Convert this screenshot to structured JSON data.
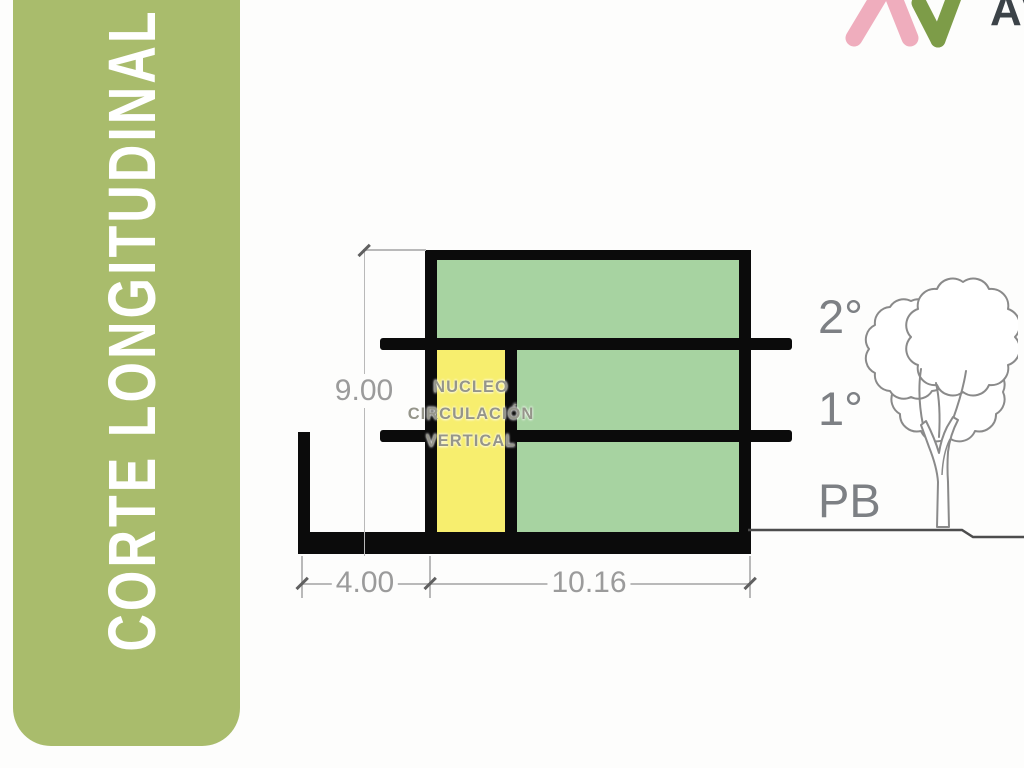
{
  "sidebar": {
    "title": "CORTE LONGITUDINAL"
  },
  "logo": {
    "text": "AV"
  },
  "drawing": {
    "floors": [
      {
        "label": "2°"
      },
      {
        "label": "1°"
      },
      {
        "label": "PB"
      }
    ],
    "core_label_lines": [
      "NUCLEO",
      "CIRCULACIÓN",
      "VERTICAL"
    ],
    "dimensions": {
      "height": "9.00",
      "left_width": "4.00",
      "right_width": "10.16"
    }
  },
  "theme": {
    "page_bg": "#fdfdfc",
    "sidebar_green": "#a9bc6c",
    "title_white": "#ffffff",
    "floor_green": "#a7d3a1",
    "core_yellow": "#f7ee6e",
    "outline_black": "#0b0b0b",
    "dim_line": "#b9b9b9",
    "dim_text": "#9b9b9b",
    "label_gray": "#7d8084",
    "ground_gray": "#4d4d4d",
    "tree_gray": "#8a8a8a",
    "logo_pink": "#efadbd",
    "logo_green": "#7d9c48",
    "logo_text_dark": "#3c4348"
  }
}
